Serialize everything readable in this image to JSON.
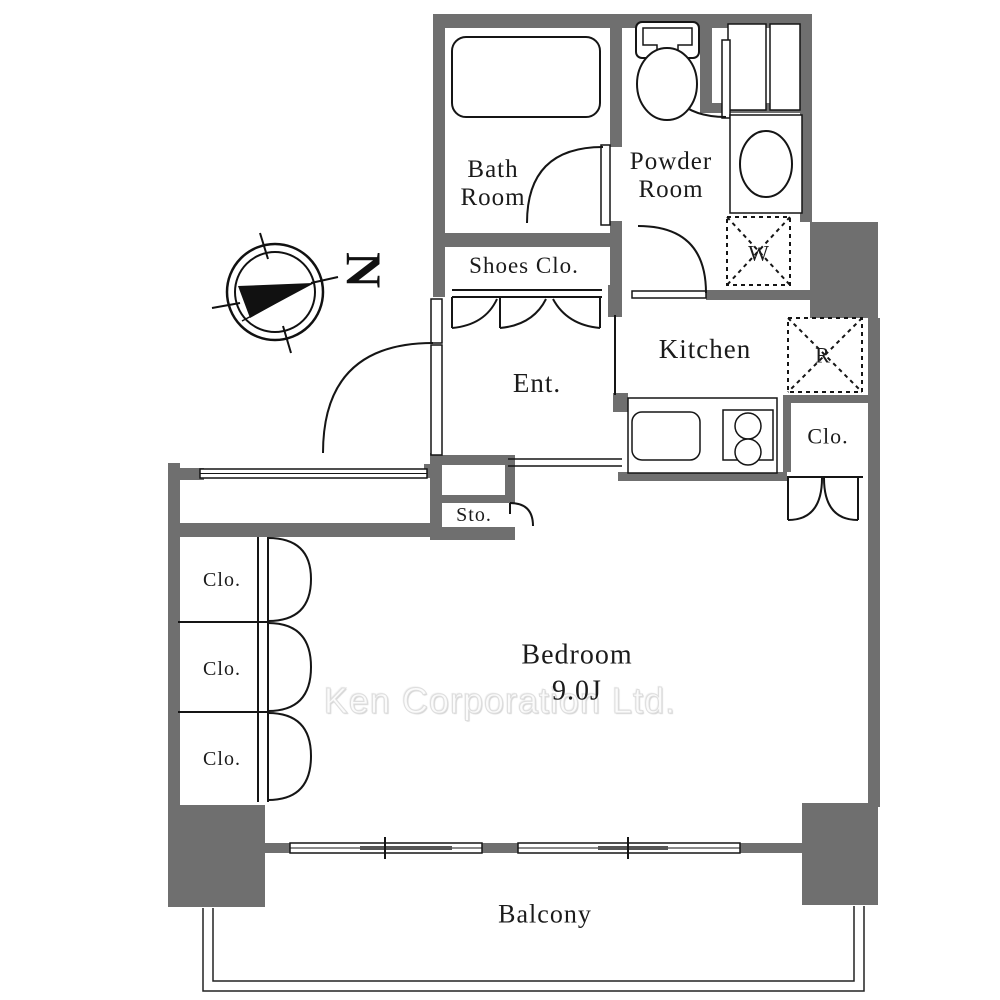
{
  "watermark": "Ken Corporation Ltd.",
  "compass": {
    "north_label": "N"
  },
  "rooms": {
    "bath": "Bath Room",
    "powder": "Powder Room",
    "shoes_closet": "Shoes Clo.",
    "entrance": "Ent.",
    "kitchen": "Kitchen",
    "storage": "Sto.",
    "closet_kitchen": "Clo.",
    "closet_1": "Clo.",
    "closet_2": "Clo.",
    "closet_3": "Clo.",
    "bedroom": "Bedroom",
    "bedroom_size": "9.0J",
    "balcony": "Balcony"
  },
  "appliances": {
    "washer": "W",
    "refrigerator": "R"
  },
  "colors": {
    "wall": "#6f6f6f",
    "line": "#151515",
    "sash": "#555555",
    "watermark": "#e2e2e2"
  }
}
